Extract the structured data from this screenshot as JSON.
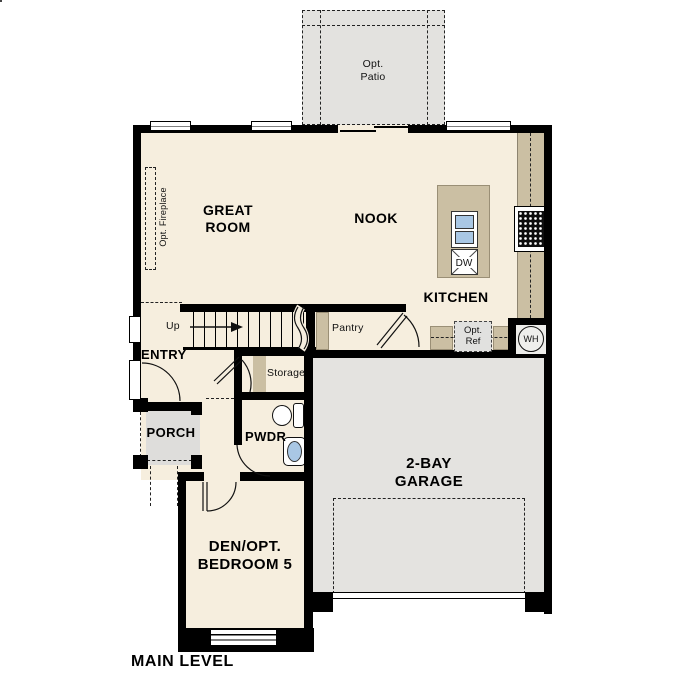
{
  "plan": {
    "level_label": "MAIN LEVEL",
    "rooms": {
      "patio": {
        "line1": "Opt.",
        "line2": "Patio"
      },
      "great_room": {
        "line1": "GREAT",
        "line2": "ROOM"
      },
      "nook": {
        "label": "NOOK"
      },
      "kitchen": {
        "label": "KITCHEN"
      },
      "pantry": {
        "label": "Pantry"
      },
      "entry": {
        "label": "ENTRY"
      },
      "storage": {
        "label": "Storage"
      },
      "porch": {
        "label": "PORCH"
      },
      "pwdr": {
        "label": "PWDR"
      },
      "garage": {
        "line1": "2-BAY",
        "line2": "GARAGE"
      },
      "den": {
        "line1": "DEN/OPT.",
        "line2": "BEDROOM 5"
      }
    },
    "features": {
      "opt_fireplace": "Opt. Fireplace",
      "up": "Up",
      "opt_ref_line1": "Opt.",
      "opt_ref_line2": "Ref",
      "water_heater": "WH",
      "dishwasher": "DW"
    },
    "colors": {
      "floor": "#f6eede",
      "exterior_surface": "#e3e2df",
      "counter": "#cbbfa3",
      "wall": "#000000",
      "sink_blue": "#a9c7e4"
    }
  }
}
